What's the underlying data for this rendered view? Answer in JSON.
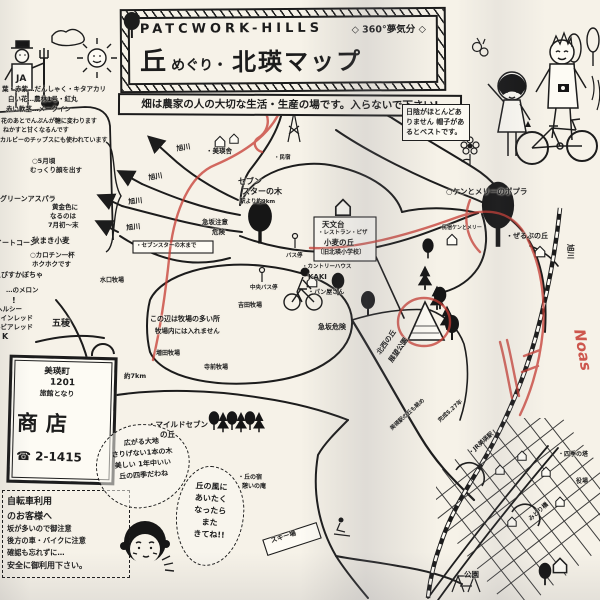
{
  "header": {
    "brand": "PATCWORK-HILLS",
    "tagline": "◇ 360°夢気分 ◇",
    "title_hill": "丘",
    "title_meguri": "めぐり・",
    "title_main": "北瑛マップ",
    "notice": "畑は農家の人の大切な生活・生産の場です。入らないで下さい!"
  },
  "farmer_badge": "JA",
  "shade_note": {
    "text": "日陰がほとんどありません 帽子があるとベストです。"
  },
  "sign": {
    "line1": "美瑛町",
    "line2": "1201",
    "line3": "旅館となり",
    "name": "商店",
    "phone": "☎ 2-1415"
  },
  "bike_notice": {
    "lines": [
      "自転車利用",
      "のお客様へ",
      "坂が多いので御注意",
      "後方の車・バイクに注意",
      "確認も忘れずに…",
      "安全に御利用下さい。"
    ]
  },
  "bubbles": {
    "field": {
      "lines": [
        "広がる大地",
        "さりげない1本の木",
        "美しい 1年中いい",
        "丘の四季だわね"
      ]
    },
    "wind": {
      "lines": [
        "丘の風に",
        "あいたく",
        "なったら",
        "また",
        "きてね!!"
      ]
    }
  },
  "map_labels": [
    {
      "t": "葉・赤紫…だんしゃく・キタアカリ",
      "x": 2,
      "y": 86,
      "s": 6.5
    },
    {
      "t": "白い花…農林1号・紅丸",
      "x": 8,
      "y": 96,
      "s": 6.5
    },
    {
      "t": "赤い軟茎…メークイン",
      "x": 6,
      "y": 106,
      "s": 6.5
    },
    {
      "t": "花のあとでんぷんが糖に変わります",
      "x": 1,
      "y": 119,
      "s": 6
    },
    {
      "t": "ねかすと甘くなるんです",
      "x": 3,
      "y": 128,
      "s": 6
    },
    {
      "t": "カルビーのチップスにも使われています",
      "x": 0,
      "y": 138,
      "s": 6
    },
    {
      "t": "○5月頃",
      "x": 32,
      "y": 158,
      "s": 6.5
    },
    {
      "t": "むっくり顔を出す",
      "x": 30,
      "y": 167,
      "s": 6.5
    },
    {
      "t": "グリーンアスパラ",
      "x": 0,
      "y": 196,
      "s": 7,
      "w": 1
    },
    {
      "t": "黄金色に",
      "x": 52,
      "y": 204,
      "s": 6.5
    },
    {
      "t": "なるのは",
      "x": 50,
      "y": 213,
      "s": 6.5
    },
    {
      "t": "7月初〜末",
      "x": 48,
      "y": 222,
      "s": 6.5
    },
    {
      "t": "秋まき小麦",
      "x": 32,
      "y": 237,
      "s": 7.5,
      "w": 1
    },
    {
      "t": "スイートコーン",
      "x": -12,
      "y": 240,
      "s": 7,
      "w": 1
    },
    {
      "t": "○カロチン一杯",
      "x": 30,
      "y": 252,
      "s": 6.5
    },
    {
      "t": "ホクホクです",
      "x": 32,
      "y": 261,
      "s": 6.5
    },
    {
      "t": "えびすかぼちゃ",
      "x": -6,
      "y": 272,
      "s": 7,
      "w": 1
    },
    {
      "t": "…のメロン",
      "x": 6,
      "y": 287,
      "s": 6.5
    },
    {
      "t": "!",
      "x": 12,
      "y": 297,
      "s": 8,
      "w": 1
    },
    {
      "t": "ヘルシー",
      "x": -4,
      "y": 306,
      "s": 6.5
    },
    {
      "t": "ワインレッド",
      "x": -6,
      "y": 315,
      "s": 6.5
    },
    {
      "t": "ルビアレッド",
      "x": -6,
      "y": 324,
      "s": 6.5
    },
    {
      "t": "K",
      "x": 2,
      "y": 333,
      "s": 8,
      "w": 1
    },
    {
      "t": "旭川",
      "x": 176,
      "y": 146,
      "r": -10,
      "s": 7
    },
    {
      "t": "旭川",
      "x": 148,
      "y": 175,
      "r": -10,
      "s": 7
    },
    {
      "t": "旭川",
      "x": 128,
      "y": 199,
      "r": -6,
      "s": 7
    },
    {
      "t": "旭川",
      "x": 126,
      "y": 225,
      "r": -6,
      "s": 7
    },
    {
      "t": "水口牧場",
      "x": 100,
      "y": 278,
      "s": 6
    },
    {
      "t": "・美瑛舎",
      "x": 206,
      "y": 148,
      "s": 6.5
    },
    {
      "t": "・民宿",
      "x": 274,
      "y": 156,
      "s": 5.5
    },
    {
      "t": "セブン",
      "x": 238,
      "y": 178,
      "s": 8,
      "w": 1
    },
    {
      "t": "スターの木",
      "x": 242,
      "y": 188,
      "s": 8,
      "w": 1
    },
    {
      "t": "駅より約9km",
      "x": 240,
      "y": 200,
      "s": 5.5
    },
    {
      "t": "・セブンスターの木まで",
      "x": 136,
      "y": 244,
      "s": 5.5
    },
    {
      "t": "急坂注意",
      "x": 202,
      "y": 219,
      "s": 6.5,
      "w": 1
    },
    {
      "t": "危険",
      "x": 212,
      "y": 229,
      "s": 6.5,
      "w": 1
    },
    {
      "t": "バス停",
      "x": 286,
      "y": 254,
      "s": 5.5
    },
    {
      "t": "中央バス停",
      "x": 250,
      "y": 286,
      "s": 5.5
    },
    {
      "t": "この辺は牧場の多い所",
      "x": 150,
      "y": 316,
      "s": 7,
      "w": 1
    },
    {
      "t": "牧場内には入れません",
      "x": 155,
      "y": 328,
      "s": 6.5
    },
    {
      "t": "吉田牧場",
      "x": 238,
      "y": 303,
      "s": 6
    },
    {
      "t": "増田牧場",
      "x": 156,
      "y": 351,
      "s": 6
    },
    {
      "t": "寺前牧場",
      "x": 204,
      "y": 365,
      "s": 6
    },
    {
      "t": "五稜",
      "x": 52,
      "y": 320,
      "s": 9,
      "w": 1
    },
    {
      "t": "約7km",
      "x": 124,
      "y": 373,
      "s": 6.5
    },
    {
      "t": "天文台",
      "x": 322,
      "y": 221,
      "s": 7.5,
      "w": 1
    },
    {
      "t": "・レストラン・ピザ",
      "x": 318,
      "y": 231,
      "s": 5.5
    },
    {
      "t": "小麦の丘",
      "x": 324,
      "y": 239,
      "s": 7.5,
      "w": 1
    },
    {
      "t": "〔旧北瑛小学校〕",
      "x": 317,
      "y": 250,
      "s": 6
    },
    {
      "t": "・カントリーハウス",
      "x": 302,
      "y": 265,
      "s": 5.5
    },
    {
      "t": "KAKI",
      "x": 308,
      "y": 274,
      "s": 7,
      "w": 1
    },
    {
      "t": "・パン屋さん",
      "x": 308,
      "y": 290,
      "s": 6
    },
    {
      "t": "急坂危険",
      "x": 318,
      "y": 324,
      "s": 7,
      "w": 1
    },
    {
      "t": "北西の丘",
      "x": 376,
      "y": 352,
      "r": -55,
      "s": 7,
      "w": 1
    },
    {
      "t": "展望公園",
      "x": 388,
      "y": 360,
      "r": -55,
      "s": 7,
      "w": 1
    },
    {
      "t": "○ケンとメリーのポプラ",
      "x": 446,
      "y": 188,
      "s": 7.5,
      "w": 1
    },
    {
      "t": "民宿ケンとメリー",
      "x": 442,
      "y": 226,
      "s": 5
    },
    {
      "t": "・ぜるぶの丘",
      "x": 506,
      "y": 233,
      "s": 7,
      "w": 1
    },
    {
      "t": "旭川",
      "x": 574,
      "y": 244,
      "r": 90,
      "s": 7.5,
      "w": 1
    },
    {
      "t": "・マイルドセブン",
      "x": 148,
      "y": 421,
      "s": 7.5,
      "w": 1
    },
    {
      "t": "の丘",
      "x": 160,
      "y": 431,
      "s": 7.5,
      "w": 1
    },
    {
      "t": "・丘の宿",
      "x": 238,
      "y": 475,
      "s": 6
    },
    {
      "t": "憩いの庵",
      "x": 242,
      "y": 484,
      "s": 6
    },
    {
      "t": "スキー場",
      "x": 270,
      "y": 538,
      "r": -18,
      "s": 6.5,
      "w": 1
    },
    {
      "t": "美瑛駅の丘も眺め",
      "x": 390,
      "y": 428,
      "r": -42,
      "s": 5.5
    },
    {
      "t": "完成S.27年",
      "x": 438,
      "y": 420,
      "r": -42,
      "s": 5.5
    },
    {
      "t": "・JR美瑛駅",
      "x": 468,
      "y": 452,
      "r": -42,
      "s": 6,
      "w": 1
    },
    {
      "t": "・四季の塔",
      "x": 558,
      "y": 452,
      "s": 6
    },
    {
      "t": "役場",
      "x": 576,
      "y": 479,
      "s": 6
    },
    {
      "t": "みどり橋",
      "x": 528,
      "y": 518,
      "r": -42,
      "s": 6
    },
    {
      "t": "公園",
      "x": 464,
      "y": 571,
      "s": 7.5,
      "w": 1
    },
    {
      "t": "Noas",
      "x": 586,
      "y": 328,
      "r": 80,
      "s": 15,
      "c": "red-note",
      "n": "red-pen-note"
    }
  ]
}
